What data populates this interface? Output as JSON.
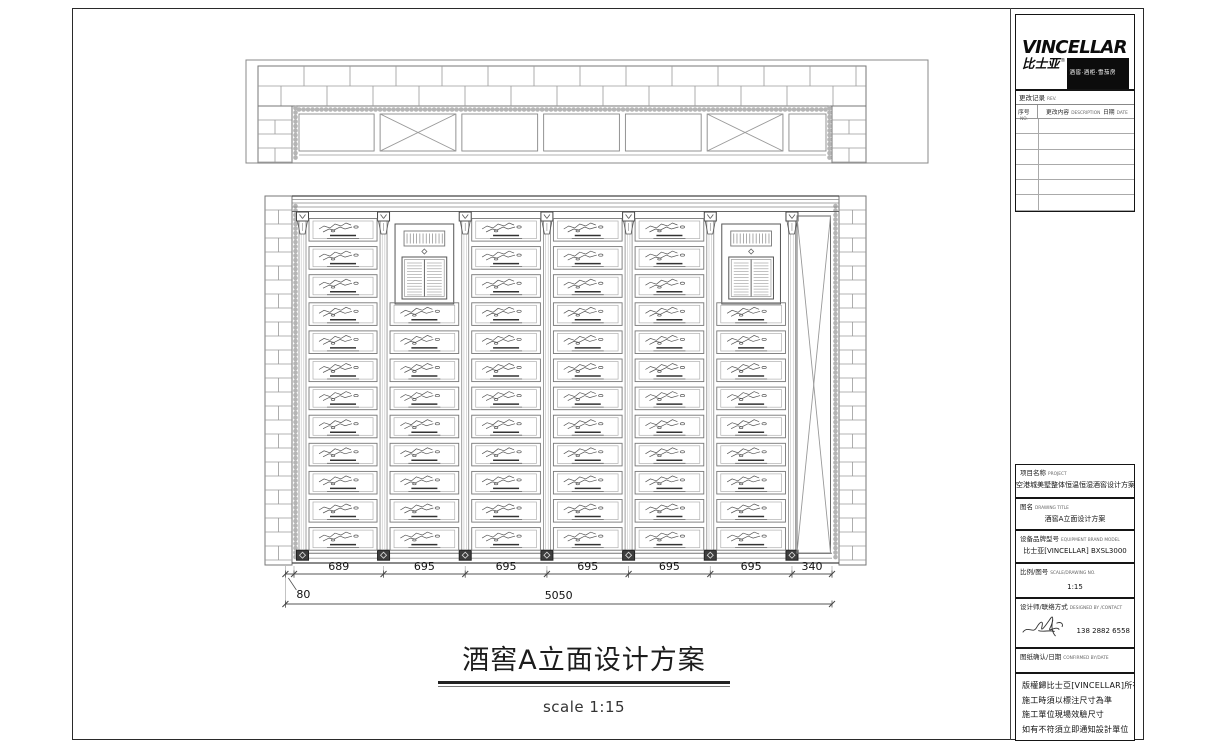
{
  "sheet": {
    "background": "#ffffff",
    "ink": "#222222",
    "line_gray": "#888888"
  },
  "logo": {
    "wordmark": "VINCELLAR",
    "cn_name": "比士亚",
    "reg_mark": "®",
    "tagline": "酒窖·酒柜·雪茄房",
    "url_line": "www.vincellar.com"
  },
  "revision": {
    "title": "更改记录",
    "title_en": "REV.",
    "columns": [
      {
        "label": "序号",
        "label_en": "NO."
      },
      {
        "label": "更改内容",
        "label_en": "DESCRIPTION"
      },
      {
        "label": "日期",
        "label_en": "DATE"
      }
    ]
  },
  "info_rows": [
    {
      "label": "项目名称",
      "label_en": "PROJECT",
      "value": "空港城美墅整体恒温恒湿酒窖设计方案"
    },
    {
      "label": "图名",
      "label_en": "DRAWING TITLE",
      "value": "酒窖A立面设计方案"
    },
    {
      "label": "设备品牌型号",
      "label_en": "EQUIPMENT BRAND MODEL",
      "value": "比士亚[VINCELLAR] BXSL3000"
    },
    {
      "label": "比例/图号",
      "label_en": "SCALE/DRAWING NO.",
      "value": "1:15"
    },
    {
      "label": "设计师/联络方式",
      "label_en": "DESIGNED BY /CONTACT",
      "value": "138 2882 6558"
    },
    {
      "label": "图纸确认/日期",
      "label_en": "CONFIRMED BY/DATE",
      "value": ""
    }
  ],
  "notes": [
    "版權歸比士亞[VINCELLAR]所有",
    "施工時須以標注尺寸為準",
    "施工單位現場效驗尺寸",
    "如有不符須立即通知設計單位"
  ],
  "drawing": {
    "title": "酒窖A立面设计方案",
    "scale_label": "scale 1:15"
  },
  "dimensions": {
    "segments": [
      "689",
      "695",
      "695",
      "695",
      "695",
      "695",
      "340"
    ],
    "offset_label": "80",
    "overall_label": "5050"
  }
}
